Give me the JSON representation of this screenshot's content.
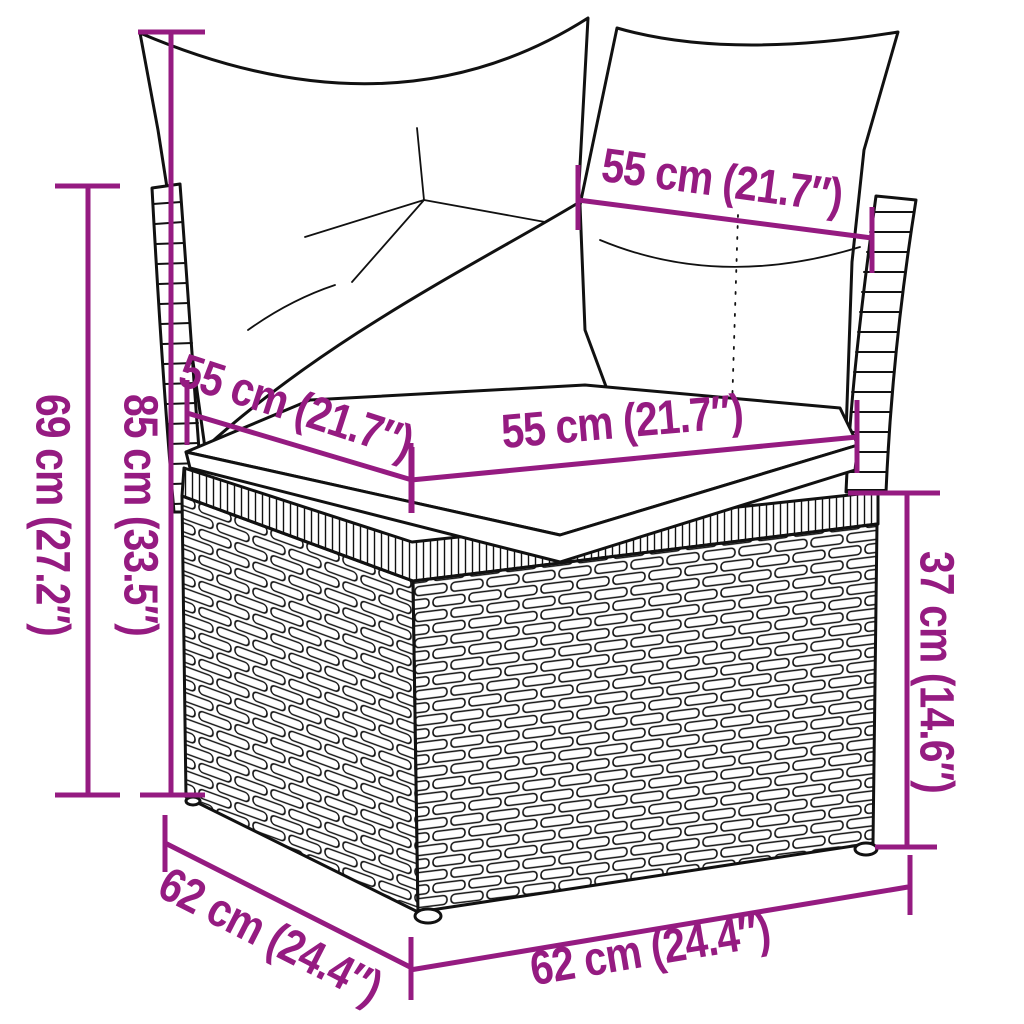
{
  "canvas": {
    "background": "#ffffff"
  },
  "colors": {
    "dimension_accent": "#951b81",
    "line_art": "#111111",
    "cushion_fill": "#ffffff"
  },
  "diagram": {
    "kind": "product-dimension-diagram",
    "subject": "poly rattan corner sofa section with back cushions and seat cushion"
  },
  "dimensions": {
    "back_height": {
      "text": "85 cm (33.5″)",
      "value_cm": 85,
      "value_in": 33.5
    },
    "outer_height": {
      "text": "69 cm (27.2″)",
      "value_cm": 69,
      "value_in": 27.2
    },
    "base_height": {
      "text": "37 cm (14.6″)",
      "value_cm": 37,
      "value_in": 14.6
    },
    "back_cushion_width": {
      "text": "55 cm (21.7″)",
      "value_cm": 55,
      "value_in": 21.7
    },
    "seat_depth": {
      "text": "55 cm (21.7″)",
      "value_cm": 55,
      "value_in": 21.7
    },
    "seat_width": {
      "text": "55 cm (21.7″)",
      "value_cm": 55,
      "value_in": 21.7
    },
    "base_depth": {
      "text": "62 cm (24.4″)",
      "value_cm": 62,
      "value_in": 24.4
    },
    "base_width": {
      "text": "62 cm (24.4″)",
      "value_cm": 62,
      "value_in": 24.4
    }
  }
}
